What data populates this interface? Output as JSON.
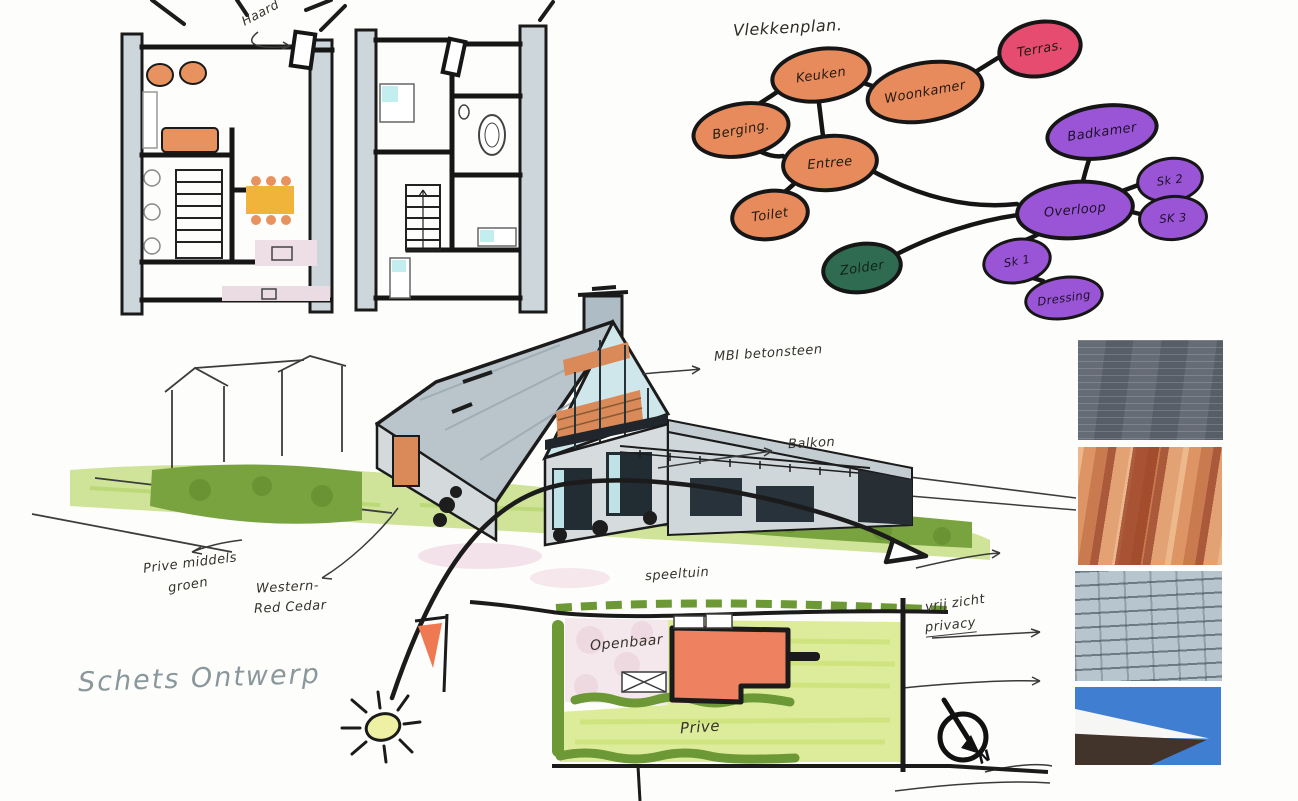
{
  "page": {
    "title": "Schets Ontwerp"
  },
  "floor_plans": {
    "haard_label": "Haard"
  },
  "bubble_diagram": {
    "title": "Vlekkenplan.",
    "nodes": [
      {
        "id": "keuken",
        "label": "Keuken",
        "color": "#e78a5c"
      },
      {
        "id": "woonkamer",
        "label": "Woonkamer",
        "color": "#e78a5c"
      },
      {
        "id": "terras",
        "label": "Terras.",
        "color": "#e64b70"
      },
      {
        "id": "berging",
        "label": "Berging.",
        "color": "#e78a5c"
      },
      {
        "id": "entree",
        "label": "Entree",
        "color": "#e78a5c"
      },
      {
        "id": "toilet",
        "label": "Toilet",
        "color": "#e78a5c"
      },
      {
        "id": "zolder",
        "label": "Zolder",
        "color": "#2e6b50"
      },
      {
        "id": "overloop",
        "label": "Overloop",
        "color": "#9a55d6"
      },
      {
        "id": "badkamer",
        "label": "Badkamer",
        "color": "#9a55d6"
      },
      {
        "id": "sk2",
        "label": "Sk 2",
        "color": "#9a55d6"
      },
      {
        "id": "sk3",
        "label": "SK 3",
        "color": "#9a55d6"
      },
      {
        "id": "sk1",
        "label": "Sk 1",
        "color": "#9a55d6"
      },
      {
        "id": "dressing",
        "label": "Dressing",
        "color": "#9a55d6"
      }
    ],
    "edges": [
      [
        "keuken",
        "berging"
      ],
      [
        "keuken",
        "woonkamer"
      ],
      [
        "woonkamer",
        "terras"
      ],
      [
        "keuken",
        "entree"
      ],
      [
        "berging",
        "entree"
      ],
      [
        "entree",
        "toilet"
      ],
      [
        "entree",
        "overloop"
      ],
      [
        "zolder",
        "overloop"
      ],
      [
        "overloop",
        "badkamer"
      ],
      [
        "overloop",
        "sk2"
      ],
      [
        "overloop",
        "sk3"
      ],
      [
        "overloop",
        "sk1"
      ],
      [
        "sk1",
        "dressing"
      ]
    ]
  },
  "annotations": {
    "mbi": "MBI betonsteen",
    "balkon": "Balkon",
    "prive_middels": "Prive middels",
    "groen": "groen",
    "western": "Western-",
    "red_cedar": "Red Cedar",
    "speeltuin": "speeltuin",
    "vrij_zicht": "vrij zicht",
    "privacy": "privacy"
  },
  "site_plan": {
    "openbaar": "Openbaar",
    "prive": "Prive"
  },
  "compass": {
    "north": "N"
  },
  "materials": [
    {
      "name": "dark-concrete-brick-strips"
    },
    {
      "name": "western-red-cedar-planks"
    },
    {
      "name": "slate-roof-tiles"
    },
    {
      "name": "white-roof-edge-blue-sky"
    }
  ],
  "colors": {
    "ink": "#1b1b1b",
    "roof": "#bac4cb",
    "wood": "#da8a58",
    "grass": "#cfe499",
    "hedge": "#79a33e",
    "building": "#ee8260",
    "openbaar_area": "#f4e8ed",
    "prive_area": "#ddec9a"
  }
}
